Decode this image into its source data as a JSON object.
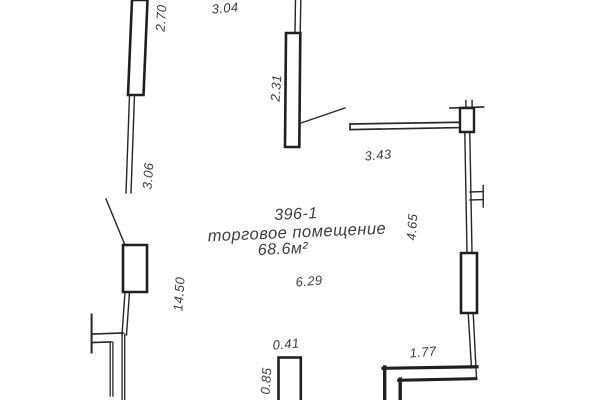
{
  "room_label": {
    "number": "396-1",
    "name": "торговое помещение",
    "area": "68.6м²"
  },
  "dimensions": {
    "window_top_left": "2.70",
    "span_top_left": "3.04",
    "window_top_center": "2.31",
    "wall_left": "3.06",
    "wall_top_right": "3.43",
    "wall_right_upper": "4.65",
    "wall_left_full": "14.50",
    "room_width": "6.29",
    "niche_width": "0.41",
    "niche_depth": "0.85",
    "wall_bottom_right": "1.77"
  },
  "colors": {
    "background": "#ffffff",
    "line": "#262626",
    "text": "#3d3d3d"
  }
}
